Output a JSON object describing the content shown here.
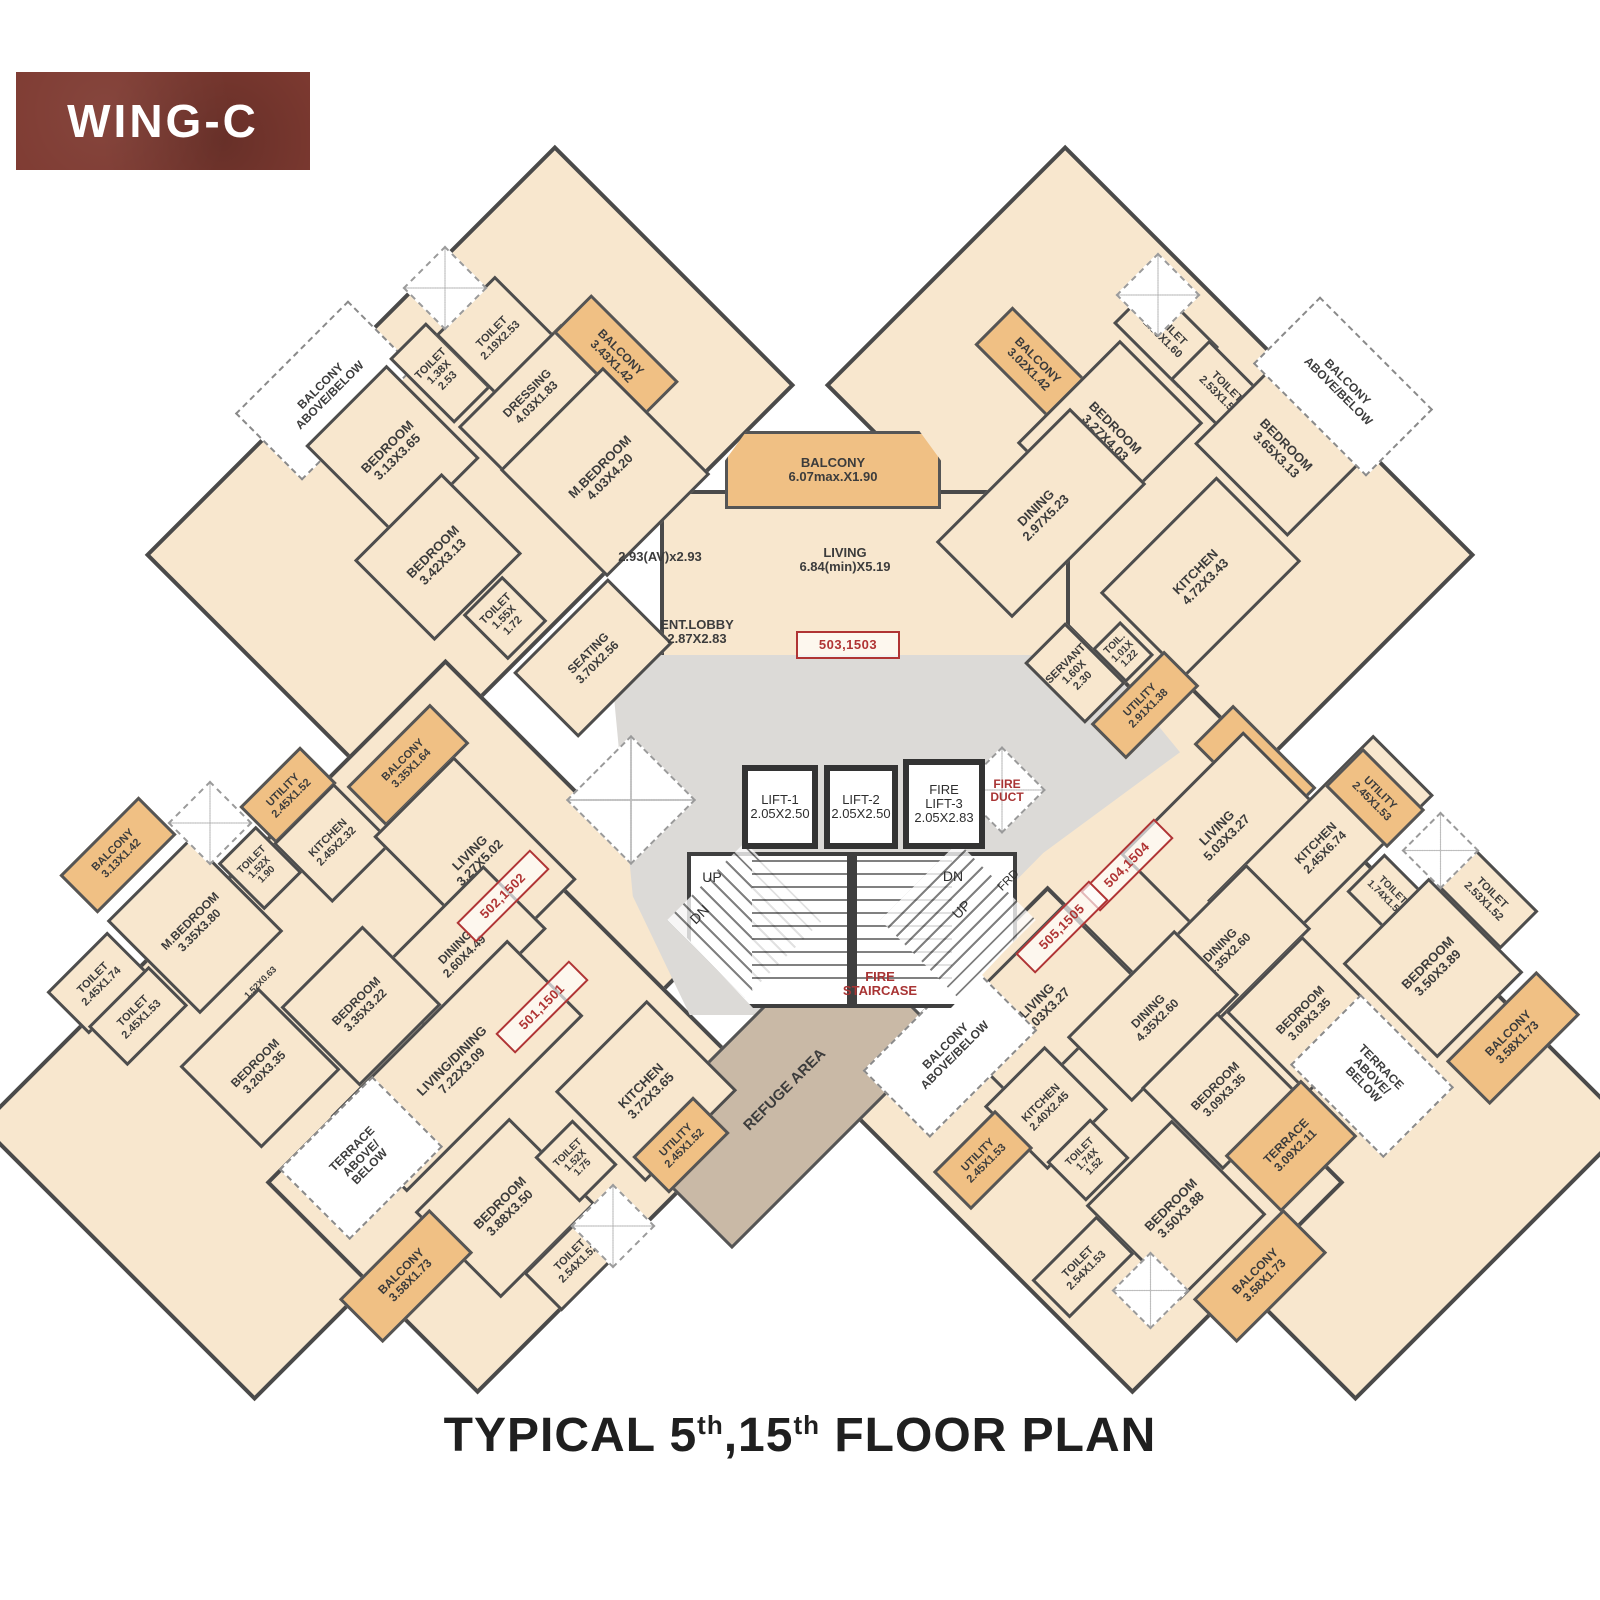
{
  "header": {
    "wing_label": "WING-C"
  },
  "footer": {
    "p1": "TYPICAL 5",
    "sup1": "th",
    "p2": ",15",
    "sup2": "th",
    "p3": " FLOOR PLAN"
  },
  "colors": {
    "room_fill": "#f8e7ce",
    "balcony_fill": "#f0c084",
    "refuge_fill": "#c9b9a6",
    "corridor_fill": "#dcdad7",
    "wall": "#4d4d4d",
    "unit_tag_red": "#b03434",
    "badge_red": "#7e3a31"
  },
  "unit_tags": [
    "501,1501",
    "502,1502",
    "503,1503",
    "504,1504",
    "505,1505"
  ],
  "rooms": [
    {
      "id": "tl_balc_ab",
      "kind": "dashed",
      "label": "BALCONY\nABOVE/BELOW"
    },
    {
      "id": "tl_bed1",
      "kind": "room",
      "label": "BEDROOM\n3.13X3.65"
    },
    {
      "id": "tl_toilet1",
      "kind": "room",
      "label": "TOILET\n1.38X\n2.53"
    },
    {
      "id": "tl_toilet2",
      "kind": "room",
      "label": "TOILET\n2.19X2.53"
    },
    {
      "id": "tl_dress",
      "kind": "room",
      "label": "DRESSING\n4.03X1.83"
    },
    {
      "id": "tl_balc1",
      "kind": "balcony",
      "label": "BALCONY\n3.43X1.42"
    },
    {
      "id": "tl_mbed",
      "kind": "room",
      "label": "M.BEDROOM\n4.03X4.20"
    },
    {
      "id": "tl_note",
      "kind": "note",
      "label": "2.93(AV)x2.93"
    },
    {
      "id": "tl_bed2",
      "kind": "room",
      "label": "BEDROOM\n3.42X3.13"
    },
    {
      "id": "tl_toilet3",
      "kind": "room",
      "label": "TOILET\n1.55X\n1.72"
    },
    {
      "id": "tl_seating",
      "kind": "room",
      "label": "SEATING\n3.70X2.56"
    },
    {
      "id": "c_entlobby",
      "kind": "note",
      "label": "ENT.LOBBY\n2.87X2.83"
    },
    {
      "id": "c_balc",
      "kind": "balcony",
      "label": "BALCONY\n6.07max.X1.90"
    },
    {
      "id": "c_living",
      "kind": "note",
      "label": "LIVING\n6.84(min)X5.19"
    },
    {
      "id": "c_tag503",
      "kind": "tag",
      "label": "503,1503"
    },
    {
      "id": "tr_balc1",
      "kind": "balcony",
      "label": "BALCONY\n3.02X1.42"
    },
    {
      "id": "tr_bed1",
      "kind": "room",
      "label": "BEDROOM\n3.27X4.03"
    },
    {
      "id": "tr_toilet1",
      "kind": "room",
      "label": "TOILET\n2.53X1.60"
    },
    {
      "id": "tr_toilet2",
      "kind": "room",
      "label": "TOILET\n2.53X1.52"
    },
    {
      "id": "tr_bed2",
      "kind": "room",
      "label": "BEDROOM\n3.65X3.13"
    },
    {
      "id": "tr_balc_ab",
      "kind": "dashed",
      "label": "BALCONY\nABOVE/BELOW"
    },
    {
      "id": "tr_dining",
      "kind": "room",
      "label": "DINING\n2.97X5.23"
    },
    {
      "id": "tr_kitchen",
      "kind": "room",
      "label": "KITCHEN\n4.72X3.43"
    },
    {
      "id": "tr_servant",
      "kind": "room",
      "label": "SERVANT\n1.60X\n2.30"
    },
    {
      "id": "tr_toil",
      "kind": "room",
      "label": "TOIL.\n1.01X\n1.22"
    },
    {
      "id": "tr_utility",
      "kind": "utility",
      "label": "UTILITY\n2.91X1.38"
    },
    {
      "id": "lift1",
      "kind": "lift",
      "label": "LIFT-1\n2.05X2.50"
    },
    {
      "id": "lift2",
      "kind": "lift",
      "label": "LIFT-2\n2.05X2.50"
    },
    {
      "id": "lift3",
      "kind": "lift",
      "label": "FIRE\nLIFT-3\n2.05X2.83"
    },
    {
      "id": "fireduct",
      "kind": "red",
      "label": "FIRE\nDUCT"
    },
    {
      "id": "firestair",
      "kind": "red",
      "label": "FIRE\nSTAIRCASE"
    },
    {
      "id": "up1",
      "kind": "dir",
      "label": "UP"
    },
    {
      "id": "dn1",
      "kind": "dir",
      "label": "DN"
    },
    {
      "id": "dn2",
      "kind": "dir",
      "label": "DN"
    },
    {
      "id": "up2",
      "kind": "dir",
      "label": "UP"
    },
    {
      "id": "frd",
      "kind": "dir",
      "label": "FRD"
    },
    {
      "id": "bl_balc1",
      "kind": "balcony",
      "label": "BALCONY\n3.13X1.42"
    },
    {
      "id": "bl_utility",
      "kind": "utility",
      "label": "UTILITY\n2.45X1.52"
    },
    {
      "id": "bl_balc2",
      "kind": "balcony",
      "label": "BALCONY\n3.35X1.64"
    },
    {
      "id": "bl_kitchen",
      "kind": "room",
      "label": "KITCHEN\n2.45X2.32"
    },
    {
      "id": "bl_toilet1",
      "kind": "room",
      "label": "TOILET\n1.52X\n1.90"
    },
    {
      "id": "bl_mbed",
      "kind": "room",
      "label": "M.BEDROOM\n3.35X3.80"
    },
    {
      "id": "bl_toilet2",
      "kind": "room",
      "label": "TOILET\n2.45X1.74"
    },
    {
      "id": "bl_toilet3",
      "kind": "room",
      "label": "TOILET\n2.45X1.53"
    },
    {
      "id": "bl_bed1",
      "kind": "room",
      "label": "BEDROOM\n3.20X3.35"
    },
    {
      "id": "bl_note",
      "kind": "note",
      "label": "1.52X0.63"
    },
    {
      "id": "bl_living",
      "kind": "room",
      "label": "LIVING\n3.27X5.02"
    },
    {
      "id": "bl_tag502",
      "kind": "tag",
      "label": "502,1502"
    },
    {
      "id": "bl_dining",
      "kind": "room",
      "label": "DINING\n2.60X4.49"
    },
    {
      "id": "bl_bed2",
      "kind": "room",
      "label": "BEDROOM\n3.35X3.22"
    },
    {
      "id": "bl_livdin",
      "kind": "room",
      "label": "LIVING/DINING\n7.22X3.09"
    },
    {
      "id": "bl_tag501",
      "kind": "tag",
      "label": "501,1501"
    },
    {
      "id": "bl_terr_ab",
      "kind": "dashed",
      "label": "TERRACE\nABOVE/\nBELOW"
    },
    {
      "id": "bl_bed3",
      "kind": "room",
      "label": "BEDROOM\n3.88X3.50"
    },
    {
      "id": "bl_toilet4",
      "kind": "room",
      "label": "TOILET\n1.52X\n1.75"
    },
    {
      "id": "bl_kitchen2",
      "kind": "room",
      "label": "KITCHEN\n3.72X3.65"
    },
    {
      "id": "bl_utility2",
      "kind": "utility",
      "label": "UTILITY\n2.45X1.52"
    },
    {
      "id": "bl_toilet5",
      "kind": "room",
      "label": "TOILET\n2.54X1.52"
    },
    {
      "id": "bl_balc3",
      "kind": "balcony",
      "label": "BALCONY\n3.58X1.73"
    },
    {
      "id": "refuge",
      "kind": "refuge",
      "label": "REFUGE AREA"
    },
    {
      "id": "br_balc1",
      "kind": "balcony",
      "label": "BALCONY\n3.35X1.56"
    },
    {
      "id": "br_living1",
      "kind": "room",
      "label": "LIVING\n5.03X3.27"
    },
    {
      "id": "br_kitchen1",
      "kind": "room",
      "label": "KITCHEN\n2.45X6.74"
    },
    {
      "id": "br_tag504",
      "kind": "tag",
      "label": "504,1504"
    },
    {
      "id": "br_tag505",
      "kind": "tag",
      "label": "505,1505"
    },
    {
      "id": "br_dining1",
      "kind": "room",
      "label": "DINING\n4.35X2.60"
    },
    {
      "id": "br_utility1",
      "kind": "utility",
      "label": "UTILITY\n2.45X1.53"
    },
    {
      "id": "br_toilet1",
      "kind": "room",
      "label": "TOILET\n1.74X1.53"
    },
    {
      "id": "br_toilet2",
      "kind": "room",
      "label": "TOILET\n2.53X1.52"
    },
    {
      "id": "br_bed1",
      "kind": "room",
      "label": "BEDROOM\n3.50X3.89"
    },
    {
      "id": "br_balc2",
      "kind": "balcony",
      "label": "BALCONY\n3.58X1.73"
    },
    {
      "id": "br_bed2",
      "kind": "room",
      "label": "BEDROOM\n3.09X3.35"
    },
    {
      "id": "br_living2",
      "kind": "room",
      "label": "LIVING\n5.03X3.27"
    },
    {
      "id": "br_dining2",
      "kind": "room",
      "label": "DINING\n4.35X2.60"
    },
    {
      "id": "br_bed3",
      "kind": "room",
      "label": "BEDROOM\n3.09X3.35"
    },
    {
      "id": "br_terr_ab",
      "kind": "dashed",
      "label": "TERRACE\nABOVE/\nBELOW"
    },
    {
      "id": "br_terrace",
      "kind": "terrace",
      "label": "TERRACE\n3.09X2.11"
    },
    {
      "id": "br_kitchen2",
      "kind": "room",
      "label": "KITCHEN\n2.40X2.45"
    },
    {
      "id": "br_toilet3",
      "kind": "room",
      "label": "TOILET\n1.74X\n1.52"
    },
    {
      "id": "br_bed4",
      "kind": "room",
      "label": "BEDROOM\n3.50X3.88"
    },
    {
      "id": "br_toilet4",
      "kind": "room",
      "label": "TOILET\n2.54X1.53"
    },
    {
      "id": "br_balc3",
      "kind": "balcony",
      "label": "BALCONY\n3.58X1.73"
    },
    {
      "id": "br_utility2",
      "kind": "utility",
      "label": "UTILITY\n2.45X1.53"
    },
    {
      "id": "br_balc_ab",
      "kind": "dashed",
      "label": "BALCONY\nABOVE/BELOW"
    }
  ]
}
